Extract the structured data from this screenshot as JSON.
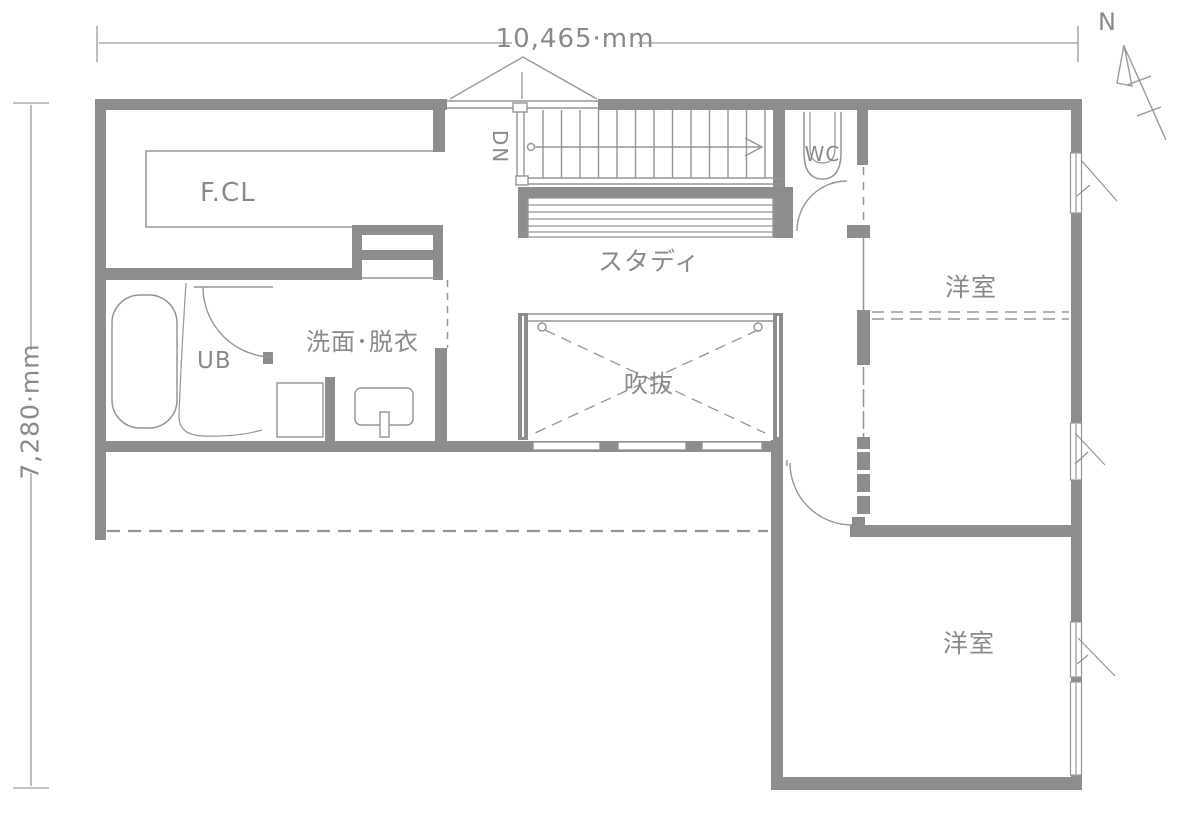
{
  "plan": {
    "dimension_width": "10,465·mm",
    "dimension_height": "7,280·mm",
    "north_label": "N",
    "rooms": {
      "family_closet": "F.CL",
      "stairs_down": "DN",
      "toilet": "WC",
      "study": "スタディ",
      "washroom": "洗面･脱衣",
      "unit_bath": "UB",
      "void": "吹抜",
      "bedroom_upper": "洋室",
      "bedroom_lower": "洋室"
    }
  },
  "colors": {
    "wall": "#8d8d8d",
    "line": "#959595",
    "text": "#8a8a8a",
    "background": "#ffffff"
  }
}
